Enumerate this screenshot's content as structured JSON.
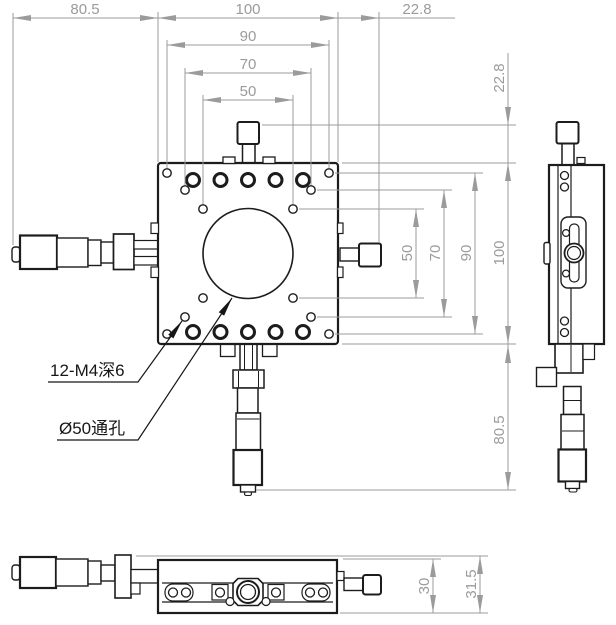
{
  "dims": {
    "top_width_left": "80.5",
    "top_width_body": "100",
    "top_width_right": "22.8",
    "top_pattern_90": "90",
    "top_pattern_70": "70",
    "top_pattern_50": "50",
    "right_offset_top": "22.8",
    "right_pattern_50": "50",
    "right_pattern_70": "70",
    "right_pattern_90": "90",
    "right_height_body": "100",
    "right_length_bottom": "80.5",
    "bottom_height_body": "30",
    "bottom_height_overall": "31.5"
  },
  "labels": {
    "tapped_holes": "12-M4深6",
    "through_hole": "Ø50通孔"
  },
  "colors": {
    "dimension": "#9b9b9b",
    "geometry": "#1c1c1c",
    "background": "#ffffff"
  }
}
